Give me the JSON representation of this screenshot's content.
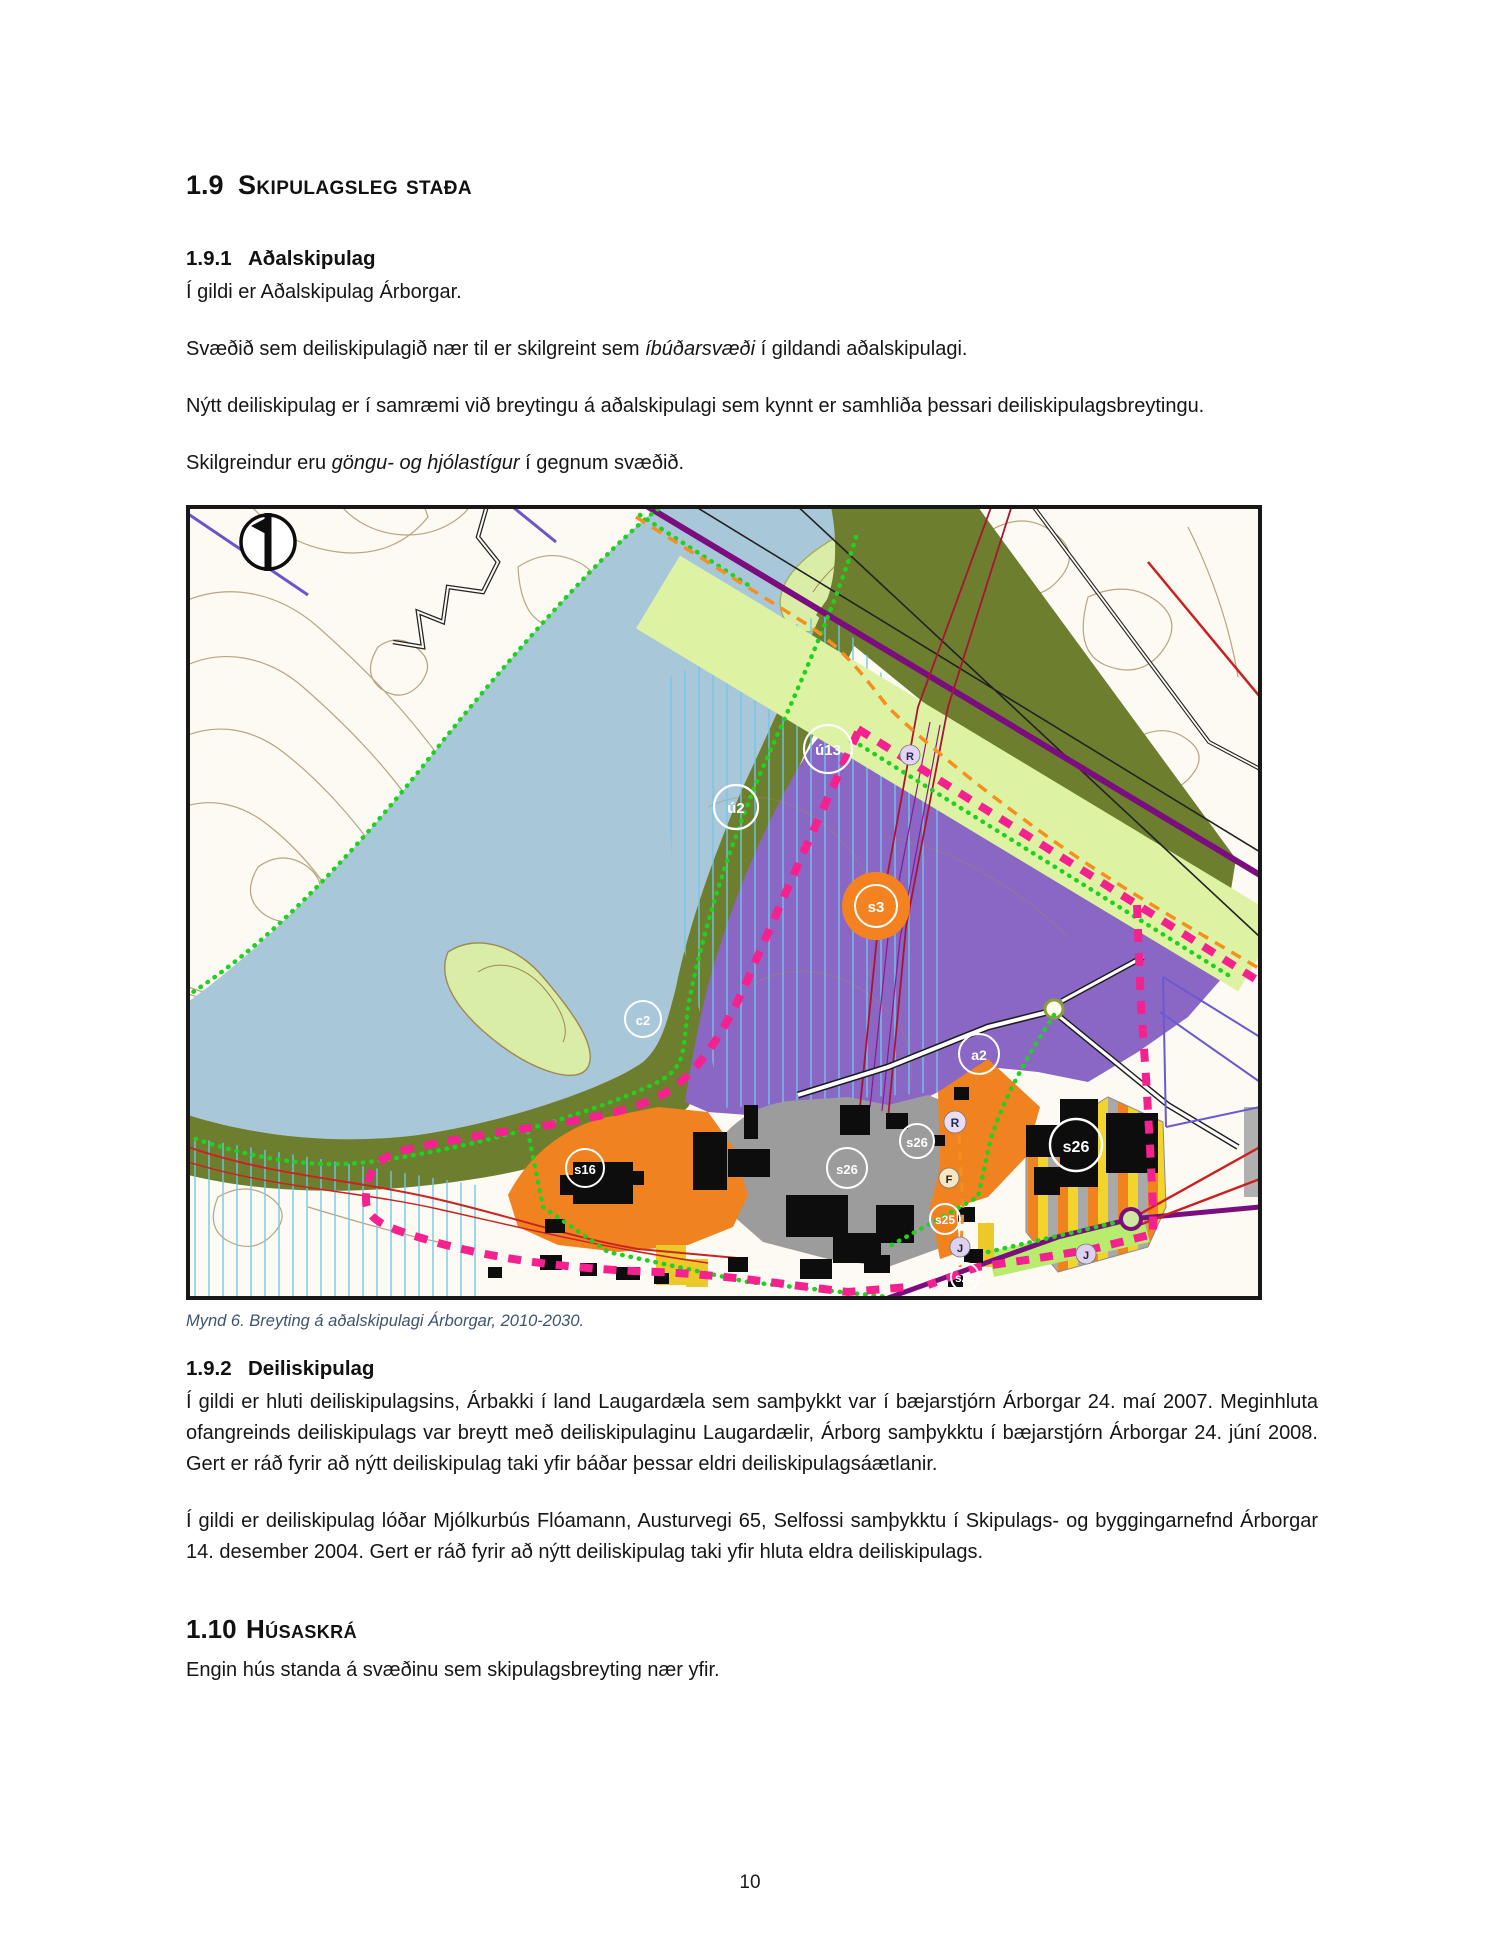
{
  "headings": {
    "h19": {
      "num": "1.9",
      "label": "Skipulagsleg staða"
    },
    "h191": {
      "num": "1.9.1",
      "label": "Aðalskipulag"
    },
    "h192": {
      "num": "1.9.2",
      "label": "Deiliskipulag"
    },
    "h110": {
      "num": "1.10",
      "label": "Húsaskrá"
    }
  },
  "paragraphs": {
    "p1": "Í gildi er Aðalskipulag Árborgar.",
    "p2a": "Svæðið sem deiliskipulagið nær til er skilgreint sem ",
    "p2i": "íbúðarsvæði",
    "p2b": " í gildandi aðalskipulagi.",
    "p3": "Nýtt deiliskipulag er í samræmi við breytingu á aðalskipulagi sem kynnt er samhliða þessari deiliskipulagsbreytingu.",
    "p4a": "Skilgreindur eru ",
    "p4i": "göngu- og hjólastígur",
    "p4b": " í gegnum svæðið.",
    "p5": "Í gildi er hluti deiliskipulagsins, Árbakki í land Laugardæla sem samþykkt var í bæjarstjórn Árborgar 24. maí 2007. Meginhluta ofangreinds deiliskipulags var breytt með deiliskipulaginu Laugardælir, Árborg samþykktu í bæjarstjórn Árborgar 24. júní 2008. Gert er ráð fyrir að nýtt deiliskipulag taki yfir báðar þessar eldri deiliskipulagsáætlanir.",
    "p6": "Í gildi er deiliskipulag lóðar Mjólkurbús Flóamann, Austurvegi 65, Selfossi samþykktu í Skipulags- og byggingarnefnd Árborgar 14. desember 2004. Gert er ráð fyrir að nýtt deiliskipulag taki yfir hluta eldra deiliskipulags.",
    "p7": "Engin hús standa á svæðinu sem skipulagsbreyting nær yfir."
  },
  "figure": {
    "caption": "Mynd 6. Breyting á aðalskipulagi Árborgar, 2010-2030."
  },
  "map": {
    "labels": {
      "u2": "ú2",
      "u13": "ú13",
      "c2": "c2",
      "s3": "s3",
      "a2": "a2",
      "r": "R",
      "f": "F",
      "j": "J",
      "s16": "s16",
      "s25": "s25",
      "s26": "s26"
    },
    "colors": {
      "lake": "#a8c8da",
      "land": "#fcfaf3",
      "contour_brown": "#b29b73",
      "open_area_green": "#6d7e2e",
      "residential_purple": "#8a67c5",
      "corridor_pale_green": "#def2a3",
      "industrial_orange": "#f08220",
      "services_gray": "#9c9c9c",
      "stripe_yellow": "#f3d42c",
      "boundary_pink": "#f5218f",
      "road_purple": "#7b0e7e",
      "path_green": "#21d121",
      "path_orange": "#f59020",
      "hatch_cyan": "#6fc8ea",
      "building_black": "#0d0d0d"
    }
  },
  "page": {
    "number": "10"
  }
}
